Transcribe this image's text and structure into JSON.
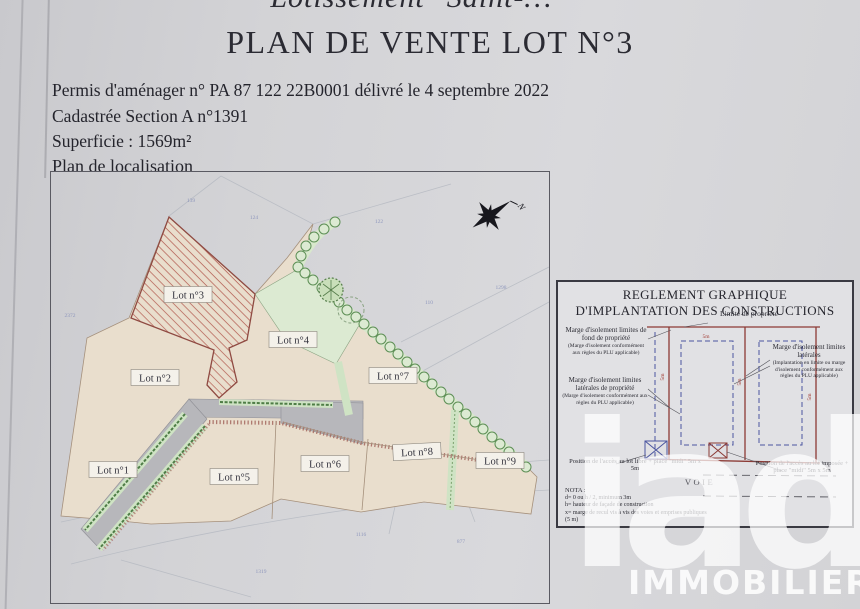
{
  "header": {
    "top_partial": "Lotissement \"Saint-…\"",
    "title": "PLAN DE VENTE LOT N°3",
    "permit_line": "Permis d'aménager n° PA 87 122 22B0001 délivré le 4 septembre 2022",
    "cadastre_line": "Cadastrée Section A n°1391",
    "area_line": "Superficie : 1569m²",
    "map_caption": "Plan de localisation"
  },
  "map": {
    "compass_label": "N",
    "lots": [
      {
        "id": "lot-1",
        "label": "Lot n°1"
      },
      {
        "id": "lot-2",
        "label": "Lot n°2"
      },
      {
        "id": "lot-3",
        "label": "Lot n°3"
      },
      {
        "id": "lot-4",
        "label": "Lot n°4"
      },
      {
        "id": "lot-5",
        "label": "Lot n°5"
      },
      {
        "id": "lot-6",
        "label": "Lot n°6"
      },
      {
        "id": "lot-7",
        "label": "Lot n°7"
      },
      {
        "id": "lot-8",
        "label": "Lot n°8"
      },
      {
        "id": "lot-9",
        "label": "Lot n°9"
      }
    ],
    "parcel_numbers": [
      "139",
      "124",
      "122",
      "2372",
      "110",
      "1298",
      "1116",
      "877",
      "1319"
    ]
  },
  "legend": {
    "title_line1": "REGLEMENT GRAPHIQUE",
    "title_line2": "D'IMPLANTATION DES CONSTRUCTIONS",
    "limit_label": "Limite de propriété",
    "label_fond": "Marge d'isolement limites de fond de propriété",
    "label_fond_sub": "(Marge d'isolement conformément aux règles du PLU applicable)",
    "label_lat": "Marge d'isolement limites latérales",
    "label_lat_sub": "(Implantation en limite ou marge d'isolement conformément aux règles du PLU applicable)",
    "label_latprop": "Marge d'isolement limites latérales de propriété",
    "label_latprop_sub": "(Marge d'isolement conformément aux règles du PLU applicable)",
    "access_free": "Position de l'accès au lot libre + place \"midi\" 5m x 5m",
    "access_imposed": "Position de l'accès au lot imposée + place \"midi\" 5m x 5m",
    "voie": "VOIE",
    "dim_5m": "5m",
    "nota_title": "NOTA :",
    "nota_lines": [
      "d= 0 ou h / 2, minimum 3m",
      "h= hauteur de façade de construction",
      "x= marge de recul vis à vis des voies et emprises publiques",
      "(5 m)"
    ]
  },
  "watermark": {
    "logo": "iad",
    "subtext": "IMMOBILIER"
  },
  "colors": {
    "paper": "#d5d5d8",
    "lot_fill": "#e9decd",
    "lot3_hatch_red": "#b25a50",
    "hedge_green": "#cfe3c4",
    "bush_green": "#5d8f55",
    "road_gray": "#b7b7bb",
    "legend_red": "#8c3a35",
    "legend_blue": "#4b55a0",
    "watermark_white": "#ffffff"
  }
}
